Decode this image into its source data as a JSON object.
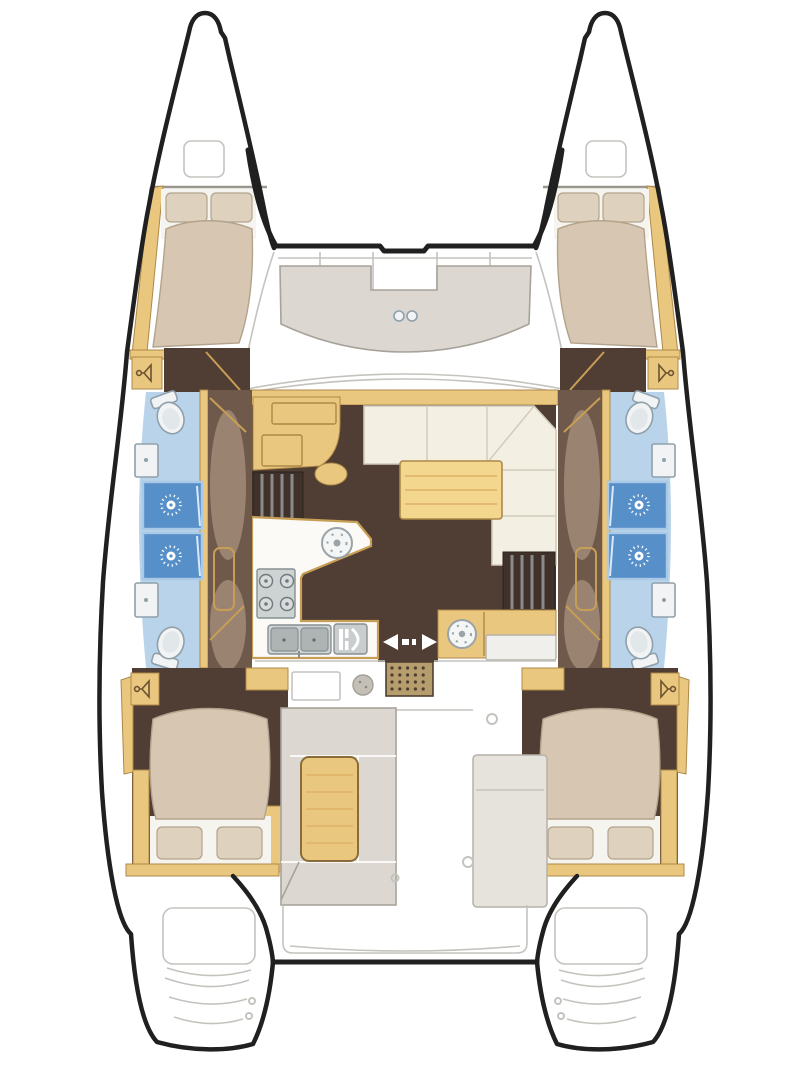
{
  "meta": {
    "description": "Catamaran sailing yacht floor plan, top-down view, bow up: four double cabins, four bathrooms with showers, central salon with galley and navigation station, cockpit with table, bow trampoline and stern swim platforms",
    "vessel_type": "catamaran",
    "orientation": "bow-up"
  },
  "colors": {
    "ink": "#202020",
    "line": "#c5c3be",
    "wall": "#9b968d",
    "paper": "#ffffff",
    "wood": "#eac77e",
    "wood-edge": "#ad8848",
    "wood-light": "#f3d78f",
    "wood-grain": "#dcb266",
    "tan-line": "#c79e55",
    "floor-dark": "#503d34",
    "corridor": "#6e594b",
    "corridor-hi": "#9a8471",
    "bed": "#d7c7b2",
    "bed-edge": "#b3a38c",
    "pillow": "#ded2bf",
    "sheet": "#f6f4ee",
    "bath-blue": "#b9d4ea",
    "shower-blue": "#578fc9",
    "shower-edge": "#aac9e6",
    "fixture": "#f1f3f4",
    "fixture-edge": "#8fa0ab",
    "steel": "#cdd2d2",
    "steel-dark": "#aeb4b4",
    "steel-edge": "#889093",
    "sofa": "#f3efe3",
    "sofa-edge": "#d2ccba",
    "seat-gray": "#dcd8d1",
    "seat-edge": "#a7a39a",
    "mat": "#b59d6e",
    "mat-dot": "#4e3e30",
    "step-dark": "#40322b",
    "step-bar": "#8a8a8a"
  },
  "areas": {
    "foredeck": {
      "features": [
        "trampoline",
        "forward-crossbeam",
        "bow-seat",
        "cup-holders",
        "deck-hatches"
      ]
    },
    "salon": {
      "features": [
        "navigation-station",
        "l-shaped-sofa",
        "coffee-table",
        "galley-counter",
        "round-sink",
        "four-burner-stove",
        "double-sink",
        "appliance",
        "sliding-entry-door",
        "entry-mat",
        "companionway-steps-port",
        "companionway-steps-starboard",
        "wet-bar-counter"
      ]
    },
    "cockpit": {
      "features": [
        "cockpit-table",
        "cockpit-bench",
        "starboard-module",
        "aft-bench",
        "aft-crossbeam"
      ]
    },
    "port_hull": {
      "cabins": [
        "forward-double-cabin",
        "aft-double-cabin"
      ],
      "toilets": 2,
      "showers": 2,
      "washbasins": 2,
      "wardrobes": 2,
      "stern": "swim-platform-steps"
    },
    "starboard_hull": {
      "cabins": [
        "forward-double-cabin",
        "aft-double-cabin"
      ],
      "toilets": 2,
      "showers": 2,
      "washbasins": 2,
      "wardrobes": 2,
      "stern": "swim-platform-steps"
    }
  }
}
